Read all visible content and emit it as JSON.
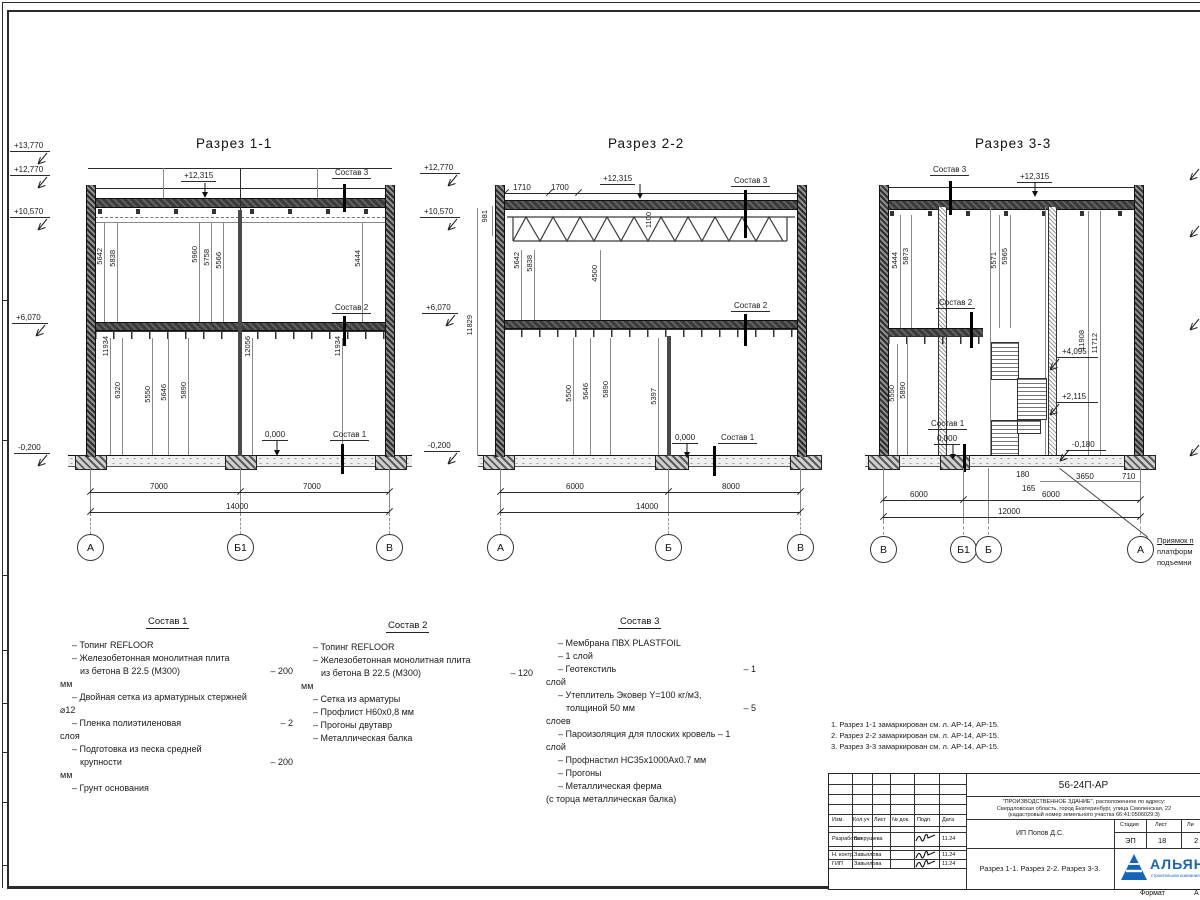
{
  "sheet": {
    "format_label": "Формат",
    "format_value": "А"
  },
  "sections": [
    {
      "title": "Разрез 1-1",
      "elev": [
        "+13,770",
        "+12,770",
        "+10,570",
        "+6,070",
        "-0,200"
      ],
      "roof_mark": "+12,315",
      "zero_mark": "0,000",
      "sostav1": "Состав 1",
      "sostav2": "Состав 2",
      "sostav3": "Состав 3",
      "upper_dims": [
        "5642",
        "5838",
        "5960",
        "5758",
        "5566",
        "5444"
      ],
      "lower_dims": [
        "11934",
        "6320",
        "5550",
        "5646",
        "5890",
        "12056",
        "11934"
      ],
      "bottom_dims": [
        "7000",
        "7000"
      ],
      "total_dim": "14000",
      "grids": [
        "А",
        "Б1",
        "В"
      ]
    },
    {
      "title": "Разрез 2-2",
      "elev": [
        "+12,770",
        "+10,570",
        "+6,070",
        "-0,200"
      ],
      "top_dims": [
        "1710",
        "1700"
      ],
      "roof_mark": "+12,315",
      "zero_mark": "0,000",
      "sostav1": "Состав 1",
      "sostav2": "Состав 2",
      "sostav3": "Состав 3",
      "truss_height": "981",
      "truss_mid": "1100",
      "truss_total": "11829",
      "upper_dims": [
        "5642",
        "5838",
        "4500"
      ],
      "lower_dims": [
        "5500",
        "5646",
        "5890",
        "5397"
      ],
      "bottom_dims": [
        "6000",
        "8000"
      ],
      "total_dim": "14000",
      "grids": [
        "А",
        "Б",
        "В"
      ]
    },
    {
      "title": "Разрез 3-3",
      "roof_mark": "+12,315",
      "zero_mark": "0,000",
      "sostav1": "Состав 1",
      "sostav2": "Состав 2",
      "sostav3": "Состав 3",
      "upper_dims": [
        "5444",
        "5873",
        "5571",
        "5965"
      ],
      "right_dims": [
        "11908",
        "11712"
      ],
      "lower_dims": [
        "5550",
        "5890"
      ],
      "level_marks": [
        "+4,095",
        "+2,115",
        "-0,180"
      ],
      "pit_dims": [
        "180",
        "165",
        "3650",
        "710"
      ],
      "bottom_dims": [
        "6000",
        "6000"
      ],
      "total_dim": "12000",
      "grids": [
        "В",
        "Б1",
        "Б",
        "А"
      ],
      "pit_note": [
        "Приямок п",
        "платформ",
        "подъемни"
      ]
    }
  ],
  "compositions": [
    {
      "title": "Состав 1",
      "lines": [
        {
          "t": "– Топинг REFLOOR",
          "v": ""
        },
        {
          "t": "– Железобетонная  монолитная плита",
          "v": ""
        },
        {
          "t": "из бетона В 22.5 (М300)",
          "v": "– 200"
        },
        {
          "t": "мм",
          "v": ""
        },
        {
          "t": "– Двойная сетка из арматурных стержней",
          "v": ""
        },
        {
          "t": "⌀12",
          "v": ""
        },
        {
          "t": "– Пленка полиэтиленовая",
          "v": "– 2"
        },
        {
          "t": "слоя",
          "v": ""
        },
        {
          "t": "– Подготовка из песка средней",
          "v": ""
        },
        {
          "t": "крупности",
          "v": "– 200"
        },
        {
          "t": "мм",
          "v": ""
        },
        {
          "t": "– Грунт основания",
          "v": ""
        }
      ]
    },
    {
      "title": "Состав 2",
      "lines": [
        {
          "t": "– Топинг REFLOOR",
          "v": ""
        },
        {
          "t": "– Железобетонная  монолитная плита",
          "v": ""
        },
        {
          "t": "из бетона В 22.5 (М300)",
          "v": "– 120"
        },
        {
          "t": "мм",
          "v": ""
        },
        {
          "t": "– Сетка из арматуры",
          "v": ""
        },
        {
          "t": "– Профлист Н60х0,8 мм",
          "v": ""
        },
        {
          "t": "– Прогоны двутавр",
          "v": ""
        },
        {
          "t": "– Металлическая балка",
          "v": ""
        }
      ]
    },
    {
      "title": "Состав 3",
      "lines": [
        {
          "t": "– Мембрана ПВХ PLASTFOIL",
          "v": ""
        },
        {
          "t": "– 1 слой",
          "v": ""
        },
        {
          "t": "– Геотекстиль",
          "v": "– 1"
        },
        {
          "t": "слой",
          "v": ""
        },
        {
          "t": "– Утеплитель Эковер Y=100 кг/м3,",
          "v": ""
        },
        {
          "t": "толщиной 50 мм",
          "v": "– 5"
        },
        {
          "t": "слоев",
          "v": ""
        },
        {
          "t": "– Пароизоляция для плоских кровель – 1",
          "v": ""
        },
        {
          "t": "слой",
          "v": ""
        },
        {
          "t": "– Профнастил НС35х1000Ах0.7 мм",
          "v": ""
        },
        {
          "t": "– Прогоны",
          "v": ""
        },
        {
          "t": "– Металлическая ферма",
          "v": ""
        },
        {
          "t": "(с торца металлическая балка)",
          "v": ""
        }
      ]
    }
  ],
  "notes": [
    "1. Разрез 1-1 замаркирован см. л. АР-14, АР-15.",
    "2. Разрез 2-2 замаркирован см. л. АР-14, АР-15.",
    "3. Разрез 3-3 замаркирован см. л. АР-14, АР-15."
  ],
  "titleblock": {
    "doc_number": "56-24П-АР",
    "project_lines": [
      "\"ПРОИЗВОДСТВЕННОЕ ЗДАНИЕ\", расположенное по адресу:",
      "Свердловская область, город Екатеринбург, улица Смоленская, 22",
      "(кадастровый номер земельного участка 66:41:0506029:3)"
    ],
    "header_cols": [
      "Изм.",
      "Кол.уч",
      "Лист",
      "№ док.",
      "Подп.",
      "Дата"
    ],
    "rows": [
      {
        "role": "Разработал",
        "name": "Вахрушева",
        "date": "11.24"
      },
      {
        "role": "Н. контр.",
        "name": "Завьялова",
        "date": "11.24"
      },
      {
        "role": "ГИП",
        "name": "Завьялова",
        "date": "11.24"
      }
    ],
    "client": "ИП Попов Д.С.",
    "stage_label": "Стадия",
    "sheet_label": "Лист",
    "sheets_label": "Ли",
    "stage": "ЭП",
    "sheet_no": "18",
    "sheets_total": "2",
    "sheet_title": "Разрез 1-1. Разрез 2-2. Разрез 3-3.",
    "logo_text": "АЛЬЯН",
    "logo_sub": "строительная компания"
  }
}
